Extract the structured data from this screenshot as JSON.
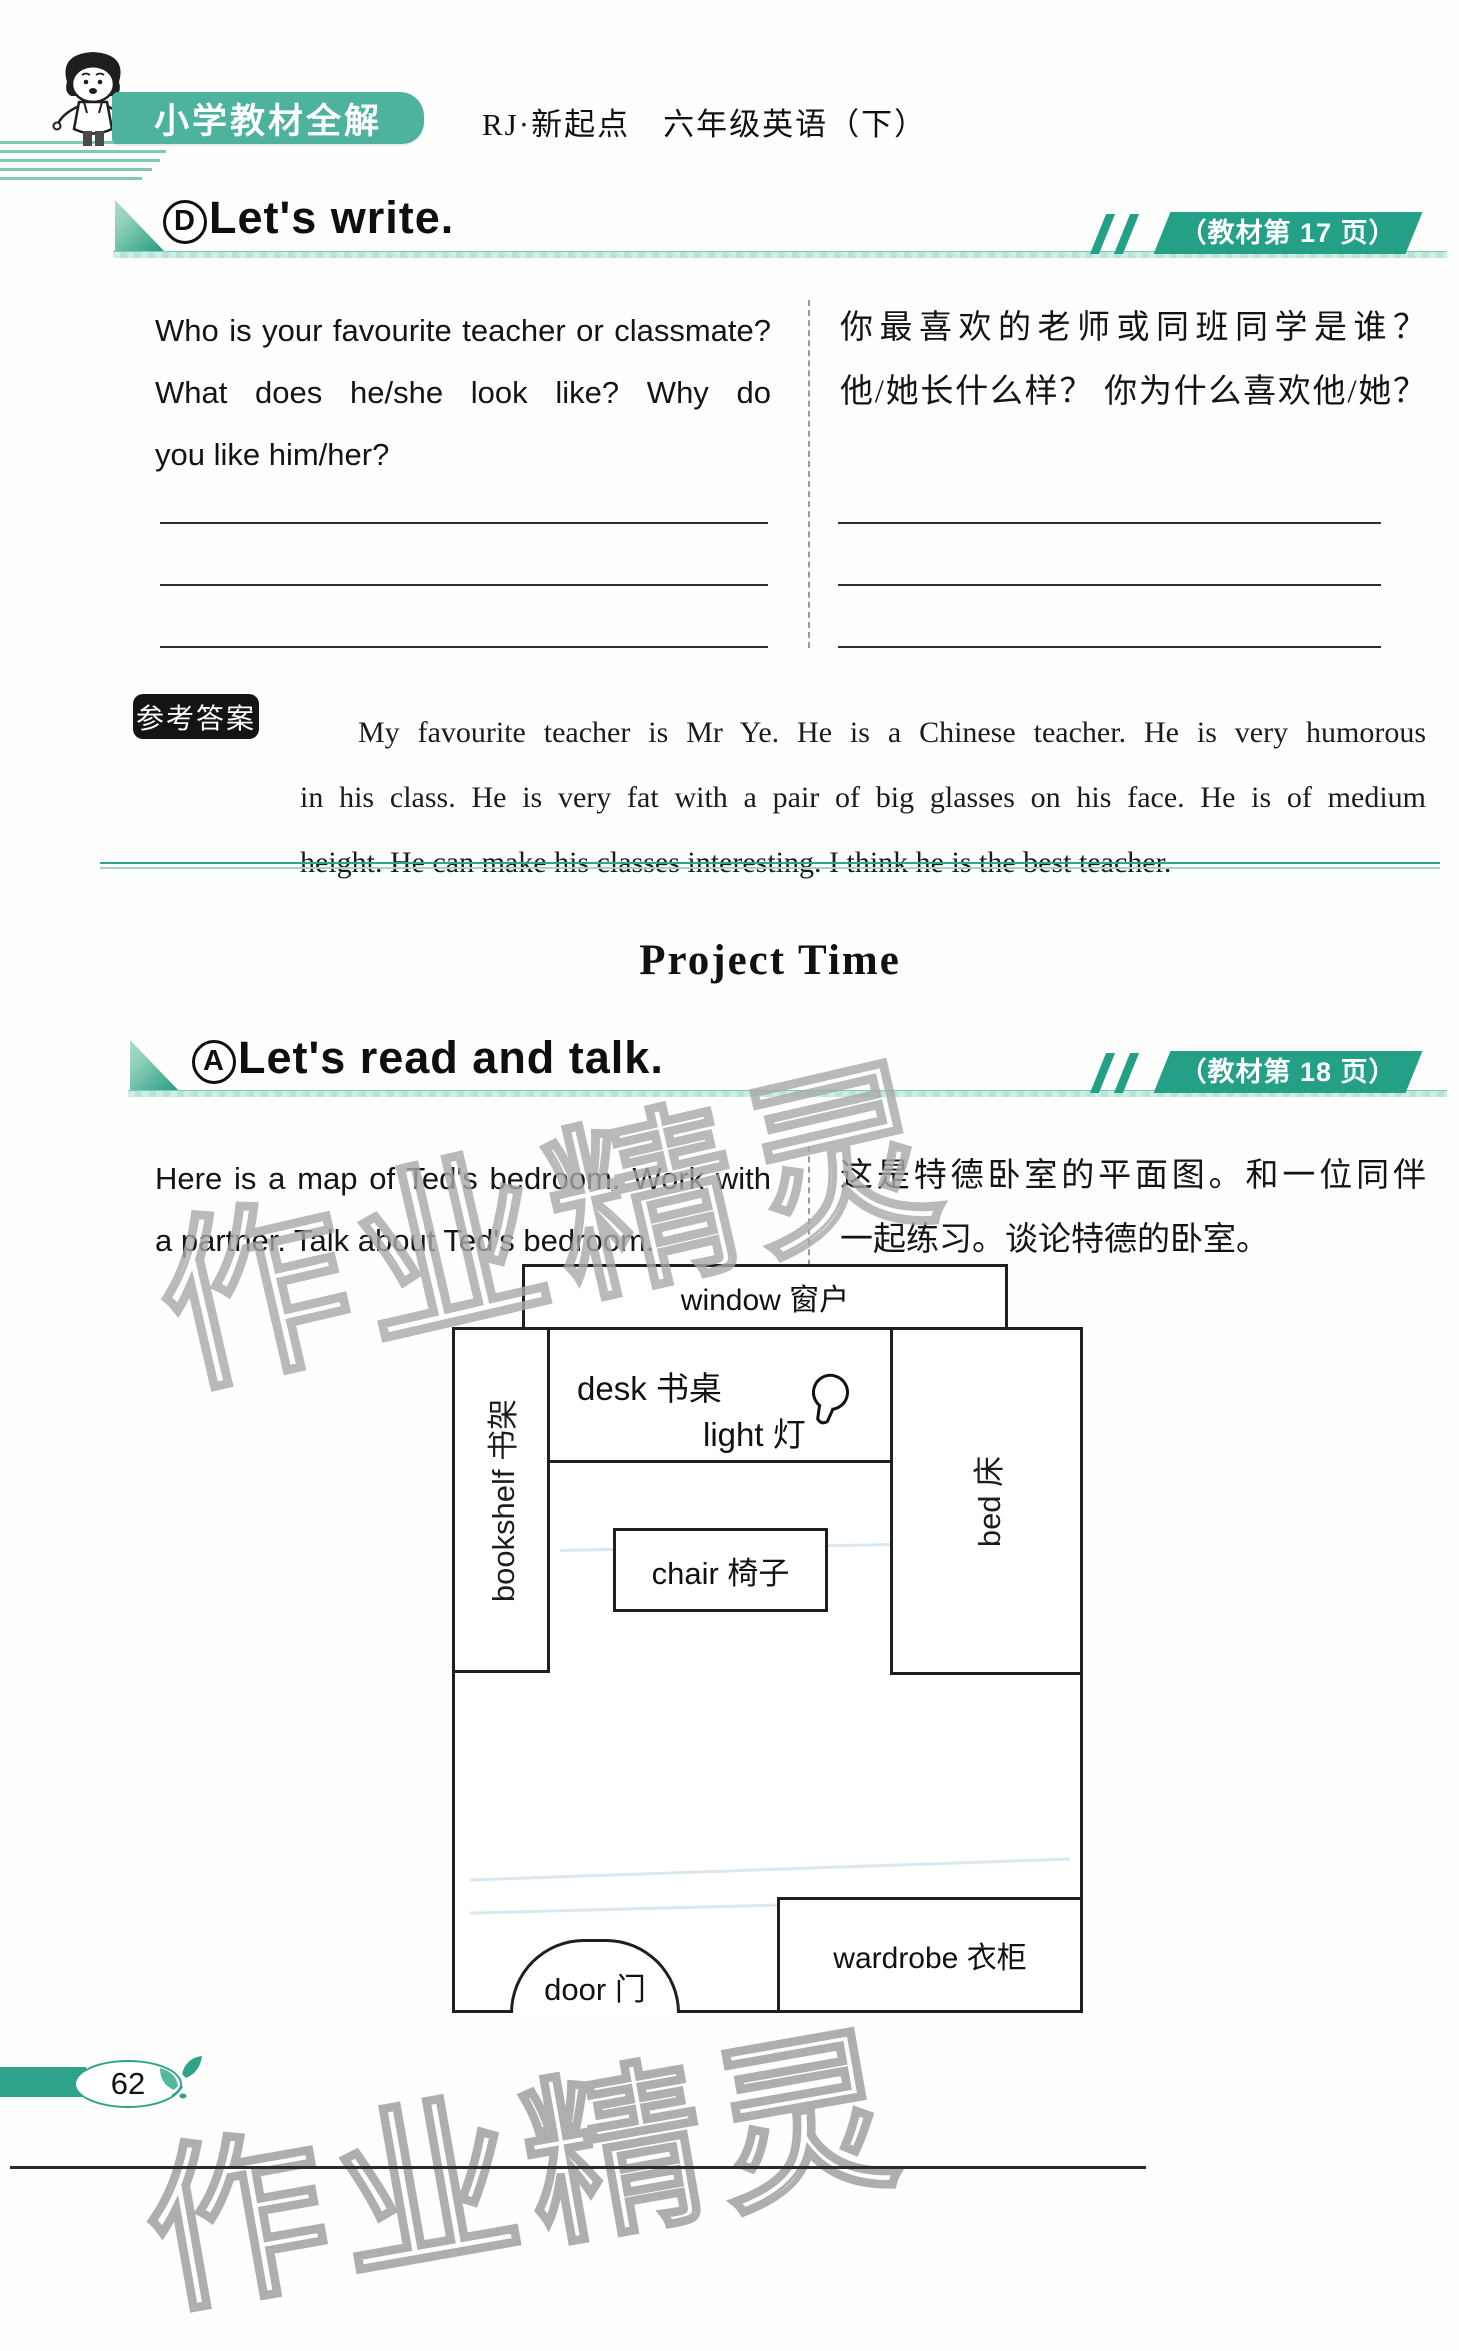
{
  "page": {
    "brand": "小学教材全解",
    "edition": "RJ·新起点　六年级英语（下）",
    "page_number": "62",
    "watermark": "作业精灵"
  },
  "section_d": {
    "badge_letter": "D",
    "title": "Let's write.",
    "page_ref": "（教材第 17 页）",
    "question_en": [
      "Who is your favourite teacher or classmate?",
      "What does he/she look like? Why do",
      "you like him/her?"
    ],
    "question_zh": [
      "你最喜欢的老师或同班同学是谁？",
      "他/她长什么样？ 你为什么喜欢他/她？"
    ],
    "answer_label": "参考答案",
    "answer_lines": [
      "My favourite teacher is Mr Ye. He is a Chinese teacher. He is very humorous",
      "in his class. He is very fat with a pair of big glasses on his face. He is of medium",
      "height. He can make his classes interesting. I think he is the best teacher."
    ]
  },
  "project_time": "Project Time",
  "section_a": {
    "badge_letter": "A",
    "title": "Let's read and talk.",
    "page_ref": "（教材第 18 页）",
    "intro_en": [
      "Here is a map of Ted's bedroom. Work with",
      "a partner. Talk about Ted's bedroom."
    ],
    "intro_zh": [
      "这是特德卧室的平面图。和一位同伴",
      "一起练习。谈论特德的卧室。"
    ],
    "map": {
      "window": "window 窗户",
      "desk": "desk 书桌",
      "light": "light 灯",
      "bookshelf": "bookshelf 书架",
      "bed": "bed 床",
      "chair": "chair 椅子",
      "door": "door 门",
      "wardrobe": "wardrobe 衣柜"
    }
  },
  "colors": {
    "brand_teal": "#4db39c",
    "badge_green": "#23a086",
    "separator_teal": "#2fa68c",
    "ink": "#1c1c1c"
  }
}
